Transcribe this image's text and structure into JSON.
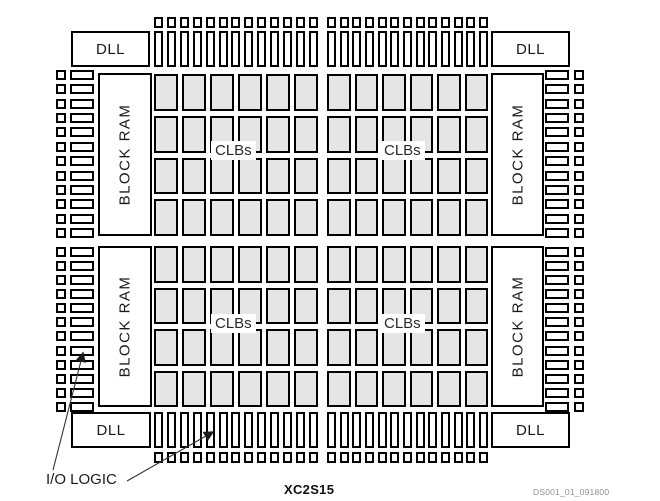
{
  "figure": {
    "part_number": "XC2S15",
    "doc_ref": "DS001_01_091800",
    "labels": {
      "dll": "DLL",
      "block_ram": "BLOCK RAM",
      "clbs": "CLBs",
      "io_logic": "I/O LOGIC"
    },
    "colors": {
      "clb_fill": "#e5e5e5",
      "outline": "#000000",
      "text": "#1a1a1a"
    },
    "structure": {
      "clb_quadrants": 4,
      "clb_cols_per_quadrant": 6,
      "clb_rows_per_quadrant": 4,
      "top_bottom_pads_per_half": 13,
      "side_pads_per_half": 12,
      "dll_count": 4,
      "block_ram_count": 4
    }
  }
}
